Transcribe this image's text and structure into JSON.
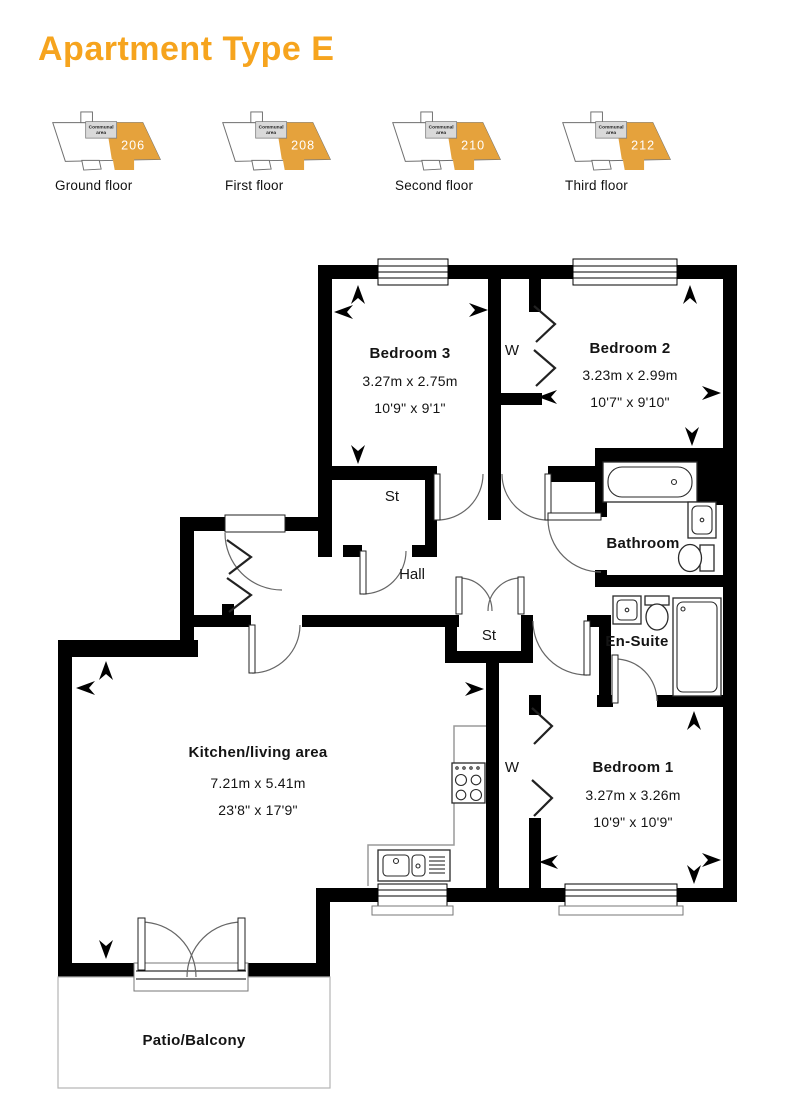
{
  "title": "Apartment Type E",
  "colors": {
    "accent_orange": "#F6A41E",
    "locator_orange": "#E5A23C",
    "wall_black": "#000000"
  },
  "floor_locators": [
    {
      "number": "206",
      "label": "Ground floor",
      "communal_line1": "Communal",
      "communal_line2": "area"
    },
    {
      "number": "208",
      "label": "First floor",
      "communal_line1": "Communal",
      "communal_line2": "area"
    },
    {
      "number": "210",
      "label": "Second floor",
      "communal_line1": "Communal",
      "communal_line2": "area"
    },
    {
      "number": "212",
      "label": "Third floor",
      "communal_line1": "Communal",
      "communal_line2": "area"
    }
  ],
  "floorplan": {
    "bedroom3": {
      "name": "Bedroom 3",
      "metric": "3.27m x 2.75m",
      "imperial": "10'9\" x 9'1\""
    },
    "bedroom2": {
      "name": "Bedroom 2",
      "metric": "3.23m x 2.99m",
      "imperial": "10'7\" x 9'10\""
    },
    "bedroom1": {
      "name": "Bedroom 1",
      "metric": "3.27m x 3.26m",
      "imperial": "10'9\" x 10'9\""
    },
    "kitchen": {
      "name": "Kitchen/living area",
      "metric": "7.21m x 5.41m",
      "imperial": "23'8\" x 17'9\""
    },
    "bathroom": {
      "name": "Bathroom"
    },
    "ensuite": {
      "name": "En-Suite"
    },
    "hall": {
      "name": "Hall"
    },
    "storage1": {
      "name": "St"
    },
    "storage2": {
      "name": "St"
    },
    "wardrobe_bed2": {
      "name": "W"
    },
    "wardrobe_bed1": {
      "name": "W"
    },
    "patio": {
      "name": "Patio/Balcony"
    }
  }
}
